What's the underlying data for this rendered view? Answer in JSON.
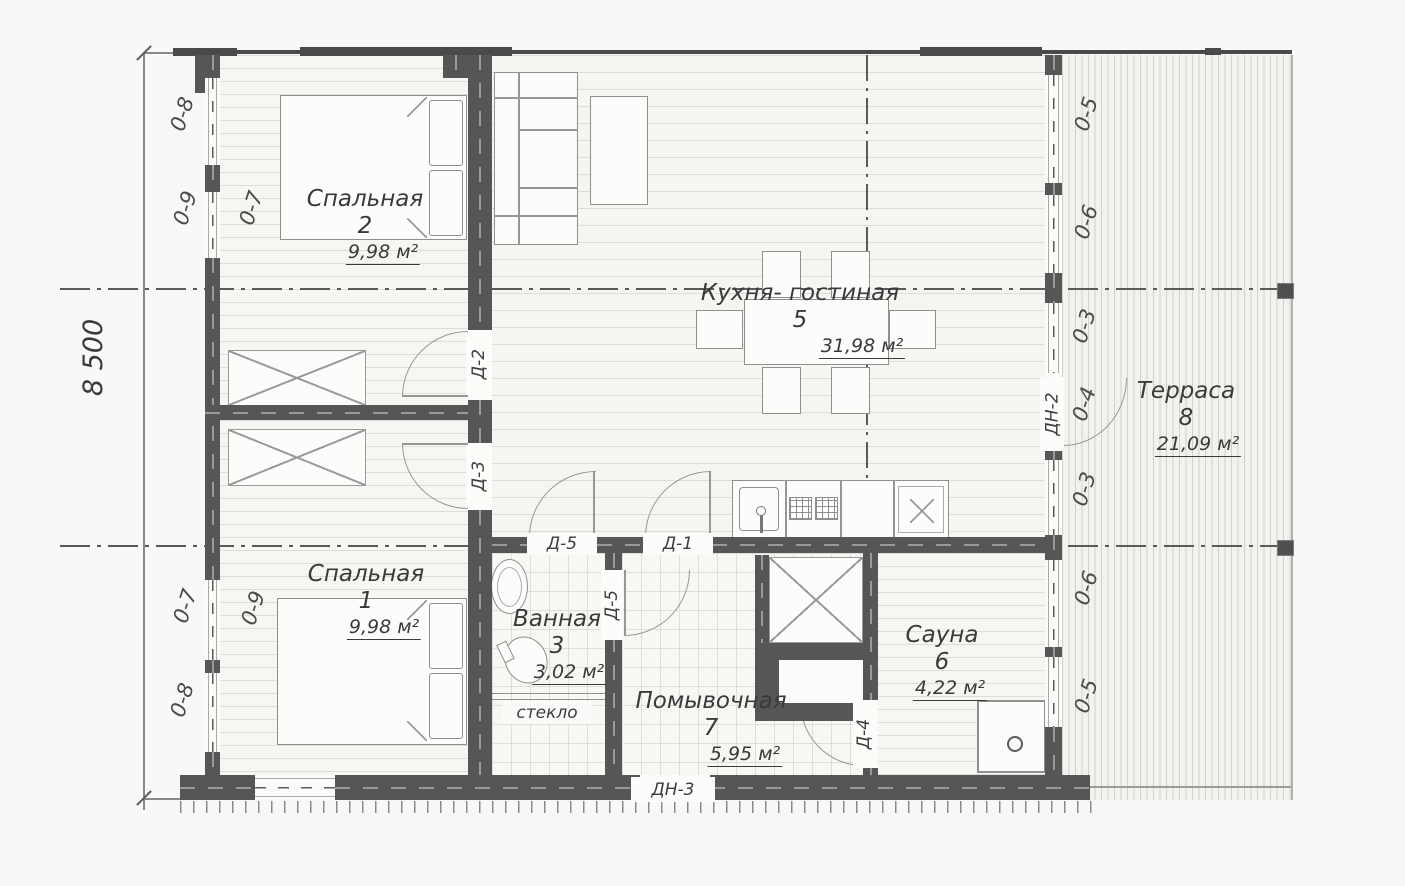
{
  "plan": {
    "dimension_left": "8 500",
    "glass_partition": "стекло",
    "rooms": [
      {
        "name": "Спальная",
        "number": "2",
        "area": "9,98 м²"
      },
      {
        "name": "Кухня- гостиная",
        "number": "5",
        "area": "31,98 м²"
      },
      {
        "name": "Терраса",
        "number": "8",
        "area": "21,09 м²"
      },
      {
        "name": "Спальная",
        "number": "1",
        "area": "9,98 м²"
      },
      {
        "name": "Ванная",
        "number": "3",
        "area": "3,02 м²"
      },
      {
        "name": "Помывочная",
        "number": "7",
        "area": "5,95 м²"
      },
      {
        "name": "Сауна",
        "number": "6",
        "area": "4,22 м²"
      }
    ],
    "doors": {
      "d2": "Д-2",
      "d3": "Д-3",
      "d5_hall": "Д-5",
      "d1": "Д-1",
      "d5_bath": "Д-5",
      "d4": "Д-4",
      "dn2": "ДН-2",
      "dn3": "ДН-3"
    },
    "windows_left": [
      "0-8",
      "0-9",
      "0-7",
      "0-7",
      "0-9",
      "0-8"
    ],
    "windows_right": [
      "0-5",
      "0-6",
      "0-3",
      "0-4",
      "0-3",
      "0-6",
      "0-5"
    ]
  }
}
